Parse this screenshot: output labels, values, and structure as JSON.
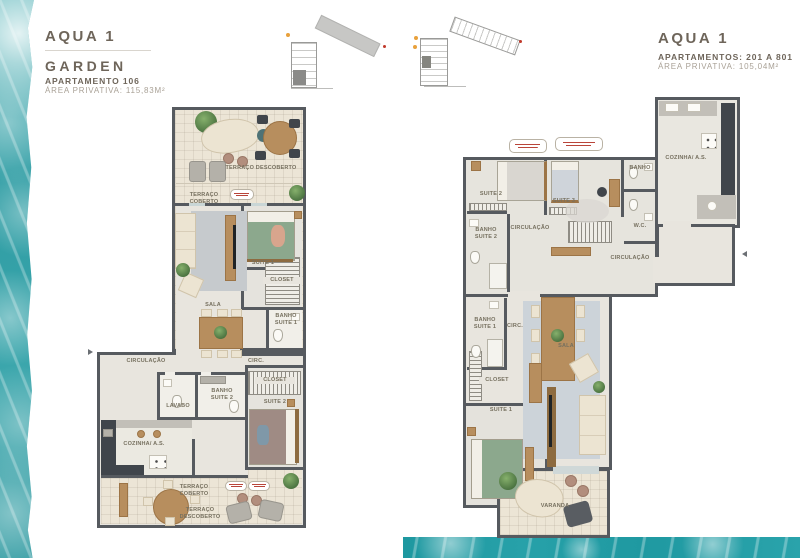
{
  "headers": {
    "left": {
      "title": "AQUA 1",
      "subtitle": "GARDEN",
      "unit": "APARTAMENTO 106",
      "area": "ÁREA PRIVATIVA: 115,83M²"
    },
    "right": {
      "title": "AQUA 1",
      "unit": "APARTAMENTOS:  201 A 801",
      "area": "ÁREA PRIVATIVA: 105,04M²"
    }
  },
  "left_plan": {
    "rooms": {
      "terraco_descoberto_top": "TERRAÇO DESCOBERTO",
      "terraco_coberto_top": "TERRAÇO COBERTO",
      "sala": "SALA",
      "suite_1": "SUITE 1",
      "closet_1": "CLOSET",
      "banho_suite_1": "BANHO SUITE 1",
      "circ": "CIRC.",
      "circulacao": "CIRCULAÇÃO",
      "lavabo": "LAVABO",
      "banho_suite_2": "BANHO SUITE 2",
      "closet_2": "CLOSET",
      "suite_2": "SUITE 2",
      "cozinha_as": "COZINHA/ A.S.",
      "terraco_coberto_bottom": "TERRAÇO COBERTO",
      "terraco_descoberto_bottom": "TERRAÇO DESCOBERTO"
    }
  },
  "right_plan": {
    "rooms": {
      "suite_2": "SUITE 2",
      "suite_3": "SUITE 3",
      "banho": "BANHO",
      "cozinha_as": "COZINHA/ A.S.",
      "wc": "W.C.",
      "banho_suite_2": "BANHO SUITE 2",
      "circulacao_upper": "CIRCULAÇÃO",
      "circulacao_right": "CIRCULAÇÃO",
      "circ": "CIRC.",
      "banho_suite_1": "BANHO SUITE 1",
      "closet": "CLOSET",
      "sala": "SALA",
      "suite_1": "SUITE 1",
      "varanda": "VARANDA"
    }
  },
  "colors": {
    "water": "#2f9da4",
    "wall": "#565a5f",
    "brand_text": "#6e655a"
  }
}
